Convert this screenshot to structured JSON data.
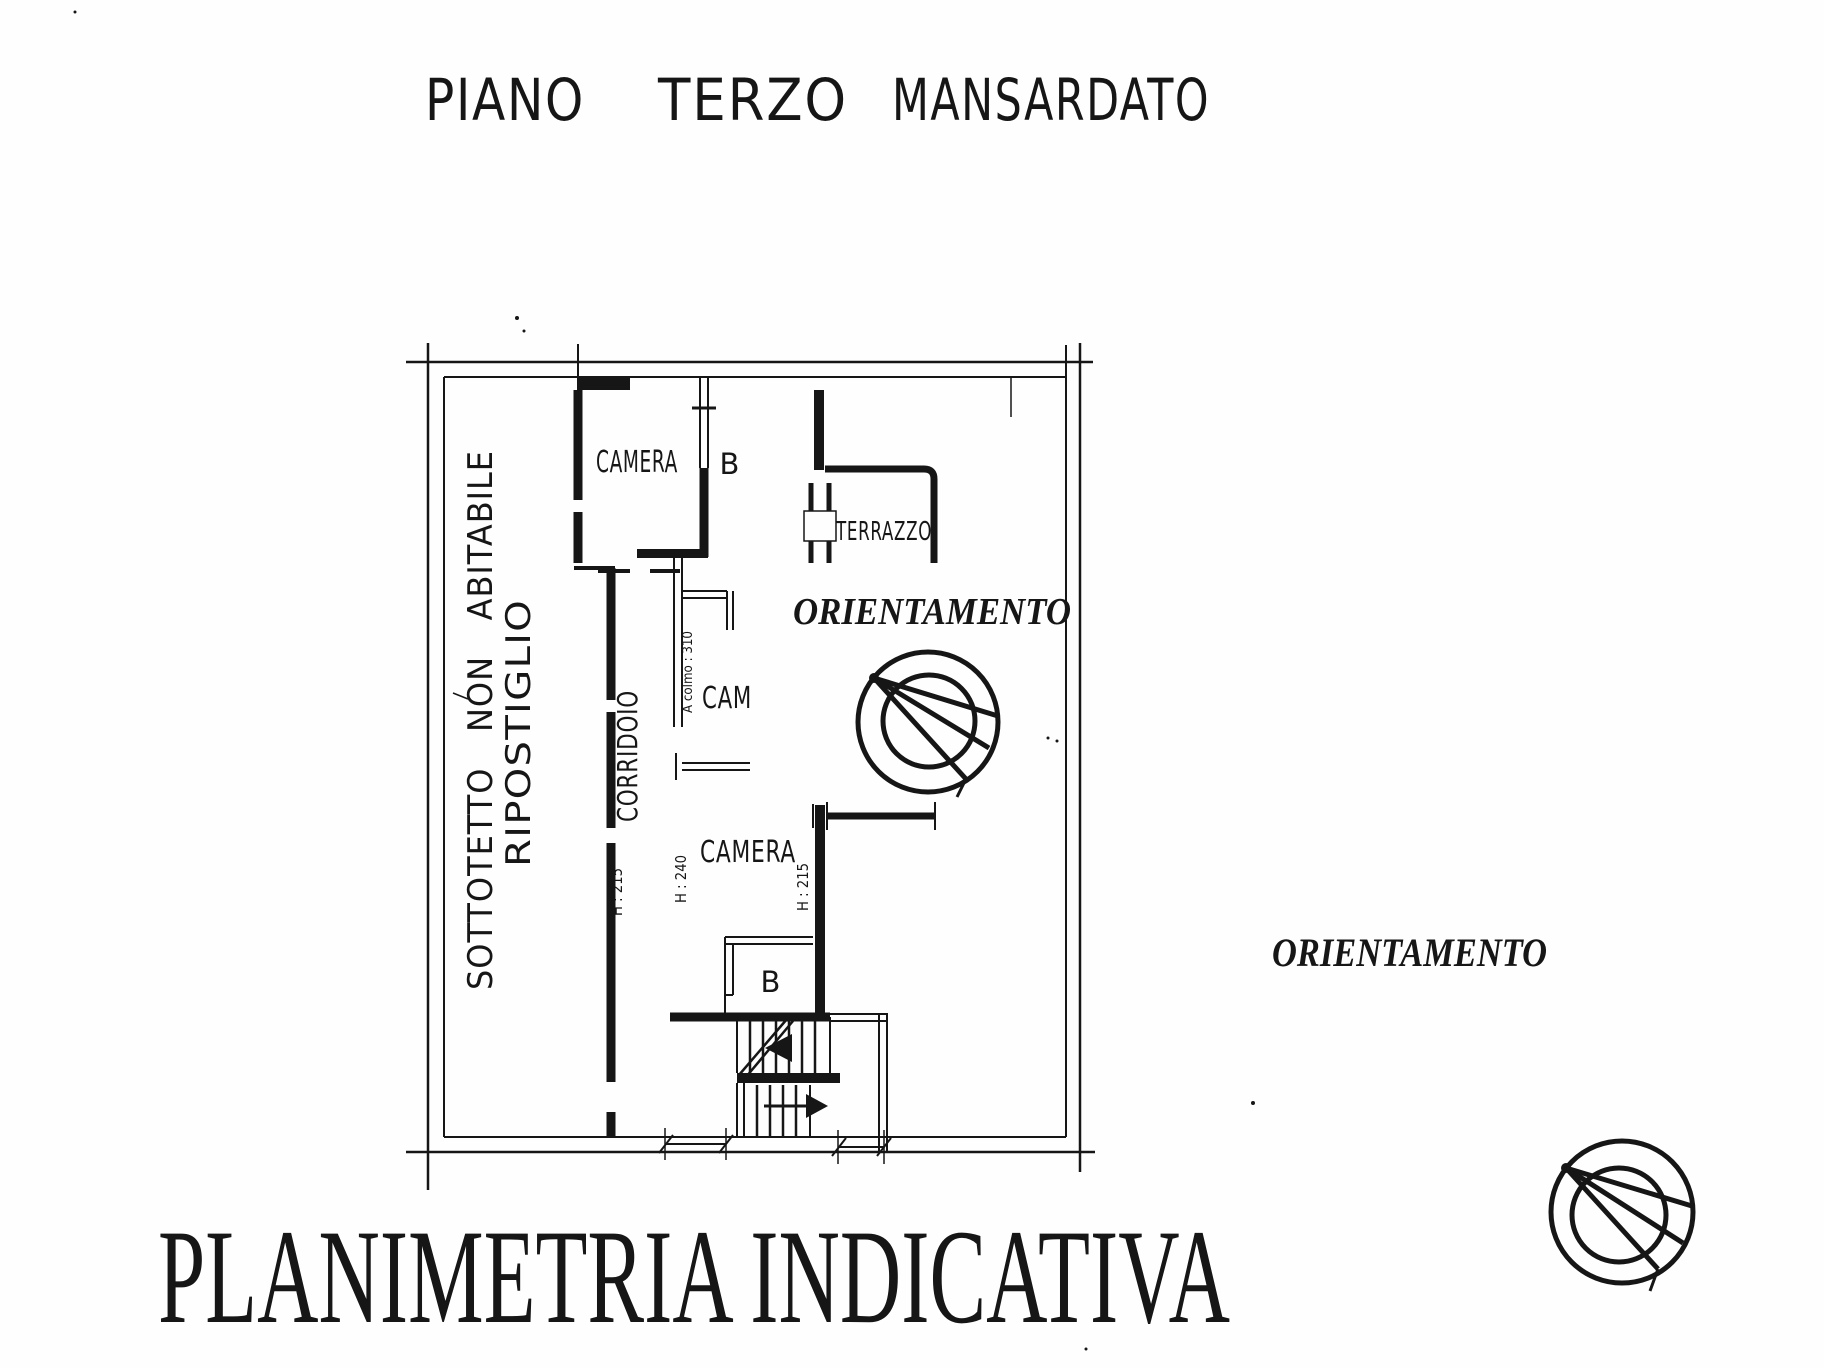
{
  "title": {
    "full": "PIANO TERZO MANSARDATO",
    "words": [
      "PIANO",
      "TERZO",
      "MANSARDATO"
    ]
  },
  "plan": {
    "rooms": {
      "camera_top": "CAMERA",
      "bath_top": "B",
      "terrazzo": "TERRAZZO",
      "camera_mid": "CAM",
      "camera_low": "CAMERA",
      "bath_low": "B",
      "corridoio": "CORRIDOIO",
      "sottotetto": "SOTTOTETTO NON ABITABILE",
      "ripostiglio": "RIPOSTIGLIO"
    },
    "annotations": {
      "h_left": "H : 215",
      "h_mid": "H : 240",
      "h_right": "H : 215",
      "ridge": "A colmo : 310"
    }
  },
  "orientation": {
    "label": "ORIENTAMENTO"
  },
  "footer": {
    "title": "PLANIMETRIA INDICATIVA"
  },
  "colors": {
    "ink": "#161616",
    "paper": "#fefefe"
  }
}
